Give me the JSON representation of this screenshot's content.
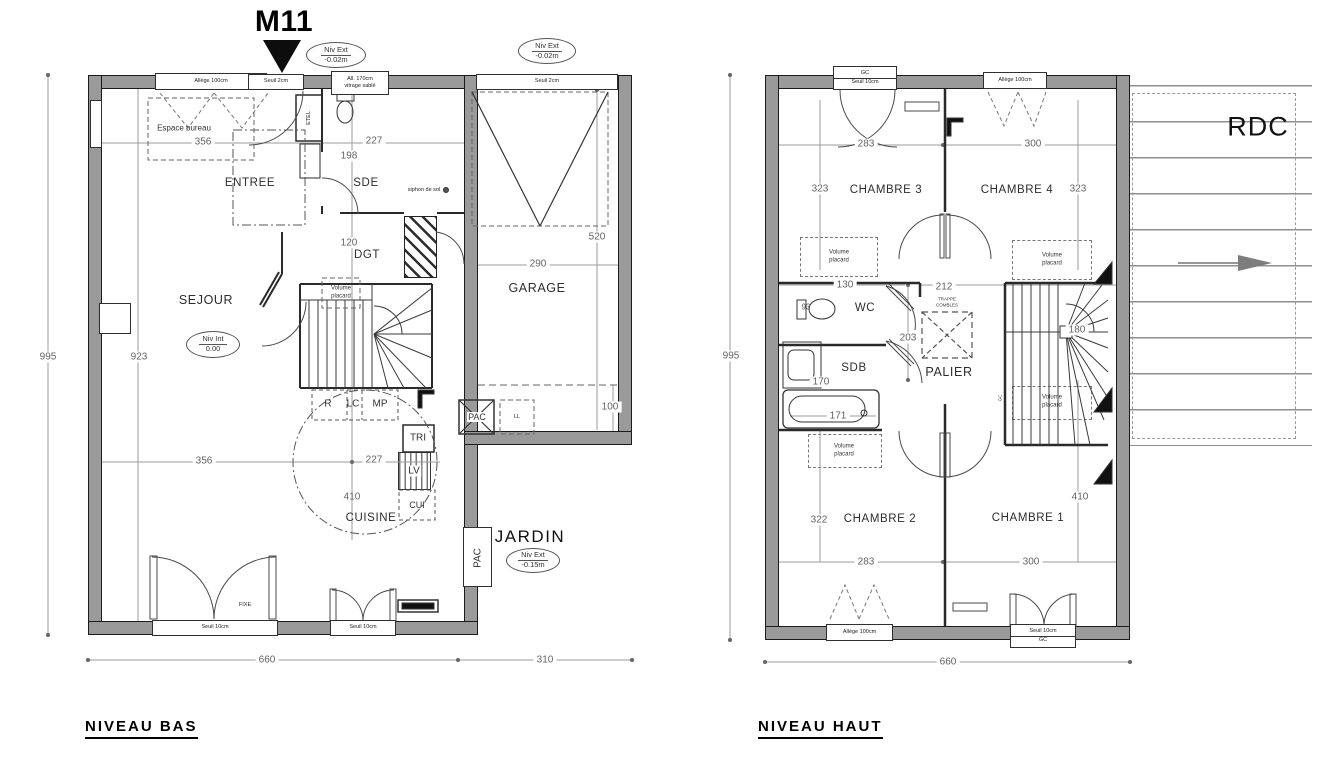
{
  "bas": {
    "marker": "M11",
    "title": "NIVEAU BAS",
    "rooms": {
      "entree": "ENTREE",
      "sde": "SDE",
      "dgt": "DGT",
      "sejour": "SEJOUR",
      "garage": "GARAGE",
      "cuisine": "CUISINE",
      "jardin": "JARDIN",
      "espace_bureau": "Espace bureau"
    },
    "badges": {
      "ext_a": {
        "l1": "Niv Ext",
        "l2": "-0.02m"
      },
      "ext_b": {
        "l1": "Niv Ext",
        "l2": "-0.02m"
      },
      "int": {
        "l1": "Niv Int",
        "l2": "0.00"
      },
      "ext_jardin": {
        "l1": "Niv Ext",
        "l2": "-0.15m"
      }
    },
    "openings": {
      "allege100": "Allège 100cm",
      "seuil2a": "Seuil 2cm",
      "alt170_l1": "All. 170cm",
      "alt170_l2": "vitrage sablé",
      "seuil2b": "Seuil 2cm",
      "seuil10a": "Seuil 10cm",
      "seuil10b": "Seuil 10cm",
      "fixe": "FIXE"
    },
    "items": {
      "etel": "ETEL",
      "siphon": "siphon de sol",
      "vp_l1": "Volume",
      "vp_l2": "placard",
      "r": "R",
      "lc": "LC",
      "mp": "MP",
      "tri": "TRI",
      "lv": "LV",
      "cui": "CUI",
      "pac": "PAC",
      "ll": "LL",
      "pac_jardin": "PAC"
    },
    "dims": {
      "w_top_left": "356",
      "w_top_sde": "227",
      "sde_h": "198",
      "dgt": "120",
      "garage_w": "290",
      "garage_h": "520",
      "total_h": "995",
      "inner_h": "923",
      "w_mid_left": "356",
      "w_mid_kitchen": "227",
      "kitchen_diag": "410",
      "garage_strip": "100",
      "total_w": "660",
      "garage_out_w": "310"
    }
  },
  "haut": {
    "title": "NIVEAU HAUT",
    "corner": "RDC",
    "rooms": {
      "ch1": "CHAMBRE 1",
      "ch2": "CHAMBRE 2",
      "ch3": "CHAMBRE 3",
      "ch4": "CHAMBRE 4",
      "wc": "WC",
      "sdb": "SDB",
      "palier": "PALIER"
    },
    "items": {
      "vp_l1": "Volume",
      "vp_l2": "placard",
      "trappe_l1": "TRAPPE",
      "trappe_l2": "COMBLES",
      "gc": "GC"
    },
    "openings": {
      "gc_top": "GC",
      "seuil10_top": "Seuil 10cm",
      "allege_top": "Allège 100cm",
      "allege_bot": "Allège 100cm",
      "seuil10_bot": "Seuil 10cm",
      "gc_bot": "GC"
    },
    "dims": {
      "ch3_w": "283",
      "ch4_w": "300",
      "ch3_h": "323",
      "ch4_h": "323",
      "wc_w": "130",
      "palier_w": "212",
      "palier_h": "203",
      "wc_d": "93",
      "sdb_h": "170",
      "bath_w": "171",
      "stair": "180",
      "ch2_h": "322",
      "ch1_h": "410",
      "ch2_w": "283",
      "ch1_w": "300",
      "total_h": "995",
      "total_w": "660"
    }
  }
}
